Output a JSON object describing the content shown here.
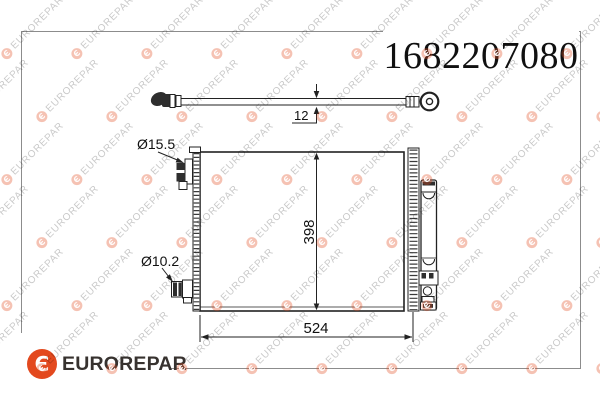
{
  "part_number": "1682207080",
  "brand": {
    "wordmark": "EUROREPAR",
    "logo_glyph": "Є",
    "logo_color": "#E3491E",
    "wordmark_color": "#37322F"
  },
  "watermark": {
    "text": "EUROREPAR",
    "glyph": "Є"
  },
  "dimensions": {
    "tube": "12",
    "height": "398",
    "width": "524",
    "port_top": "Ø15.5",
    "port_bottom": "Ø10.2"
  }
}
